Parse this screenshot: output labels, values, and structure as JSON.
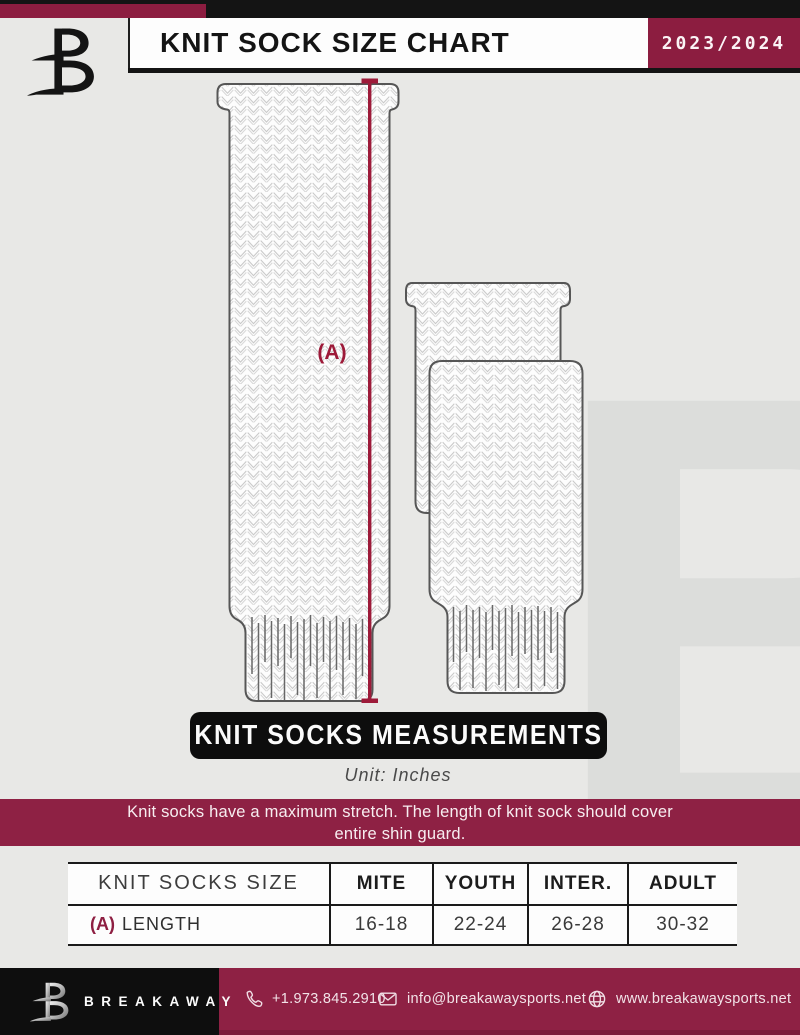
{
  "header": {
    "title": "KNIT SOCK SIZE CHART",
    "season": "2023/2024"
  },
  "diagram": {
    "length_label": "(A)"
  },
  "measurements_banner": {
    "title": "KNIT SOCKS MEASUREMENTS",
    "unit_note": "Unit: Inches"
  },
  "stretch_note": {
    "line1": "Knit socks have a maximum stretch. The length of knit sock should cover",
    "line2": "entire shin guard."
  },
  "size_table": {
    "columns": [
      "KNIT SOCKS SIZE",
      "MITE",
      "YOUTH",
      "INTER.",
      "ADULT"
    ],
    "row": {
      "prefix": "(A)",
      "label": "LENGTH",
      "values": [
        "16-18",
        "22-24",
        "26-28",
        "30-32"
      ]
    }
  },
  "footer": {
    "brand": "BREAKAWAY",
    "phone": "+1.973.845.2910",
    "email": "info@breakawaysports.net",
    "website": "www.breakawaysports.net"
  },
  "watermark": {
    "letter": "B"
  },
  "colors": {
    "maroon": "#8e2144",
    "maroon_dark": "#8c1d40",
    "accent_line": "#9d1a39",
    "black": "#0d0d0d",
    "background": "#e8e8e6"
  }
}
